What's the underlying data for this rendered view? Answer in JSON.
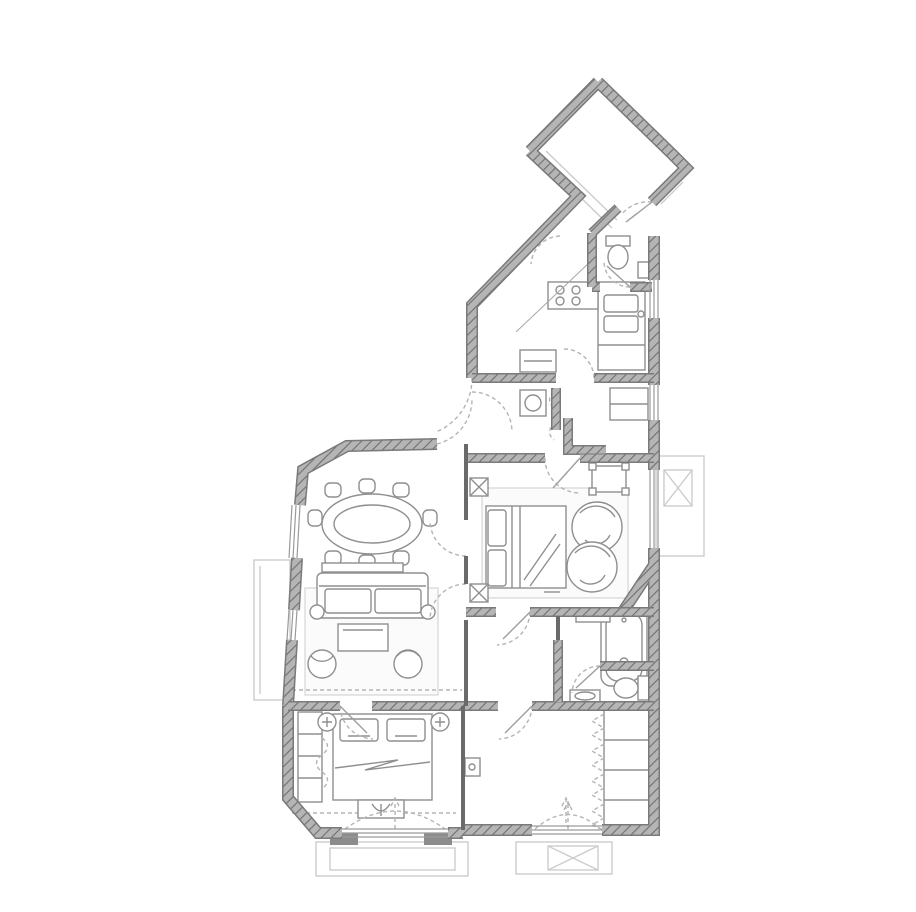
{
  "plan": {
    "aria_label": "Apartment floor plan",
    "style": "grayscale architectural line drawing with hatched walls",
    "colors": {
      "background": "#ffffff",
      "wall_fill": "#b5b5b5",
      "wall_hatch": "#6f6f6f",
      "wall_edge": "#7a7a7a",
      "furniture_line": "#8f8f8f",
      "light_line": "#cccccc",
      "dashed_line": "#b4b4b4",
      "rug_fill": "#fbfbfb"
    },
    "rooms": [
      {
        "name": "entry-hall",
        "position": "top, rotated diamond shaped room"
      },
      {
        "name": "corridor",
        "position": "diagonal passage from entry hall down to living area"
      },
      {
        "name": "wc",
        "position": "small toilet room right of entry corridor"
      },
      {
        "name": "kitchen",
        "position": "right side below wc, counters along right wall"
      },
      {
        "name": "utility-room",
        "position": "between kitchen and master bedroom"
      },
      {
        "name": "master-bedroom",
        "position": "center right"
      },
      {
        "name": "bathroom",
        "position": "below master bedroom, tub and toilet"
      },
      {
        "name": "living-dining-room",
        "position": "left, chamfered top corner"
      },
      {
        "name": "bedroom",
        "position": "bottom left"
      },
      {
        "name": "dressing-room",
        "position": "bottom right with closet wall"
      }
    ],
    "furniture": [
      {
        "room": "living-dining-room",
        "items": [
          "oval dining table with 8 chairs",
          "sideboard",
          "sofa with two cushions",
          "coffee table",
          "2 armchairs",
          "rug"
        ]
      },
      {
        "room": "master-bedroom",
        "items": [
          "double bed with headboard panels",
          "2 round swivel chairs",
          "small desk",
          "rug",
          "2 radiators"
        ]
      },
      {
        "room": "bedroom",
        "items": [
          "double bed with 2 pillows",
          "2 round nightstands",
          "foot bench",
          "wardrobe shelves",
          "bay window"
        ]
      },
      {
        "room": "bathroom",
        "items": [
          "bathtub",
          "toilet",
          "washbasin",
          "shelf"
        ]
      },
      {
        "room": "kitchen",
        "items": [
          "counter with double sink",
          "cooktop",
          "island unit"
        ]
      },
      {
        "room": "utility-room",
        "items": [
          "washing machine",
          "shelving",
          "curtain"
        ]
      },
      {
        "room": "wc",
        "items": [
          "toilet",
          "corner basin"
        ]
      },
      {
        "room": "dressing-room",
        "items": [
          "closet with 4 folding sections",
          "wall cabinet"
        ]
      }
    ],
    "exterior": [
      "left balcony outline",
      "right balcony with air-conditioning unit",
      "bottom bay window with double outline",
      "bottom window with air-conditioning unit",
      "entry steps at top right"
    ]
  }
}
